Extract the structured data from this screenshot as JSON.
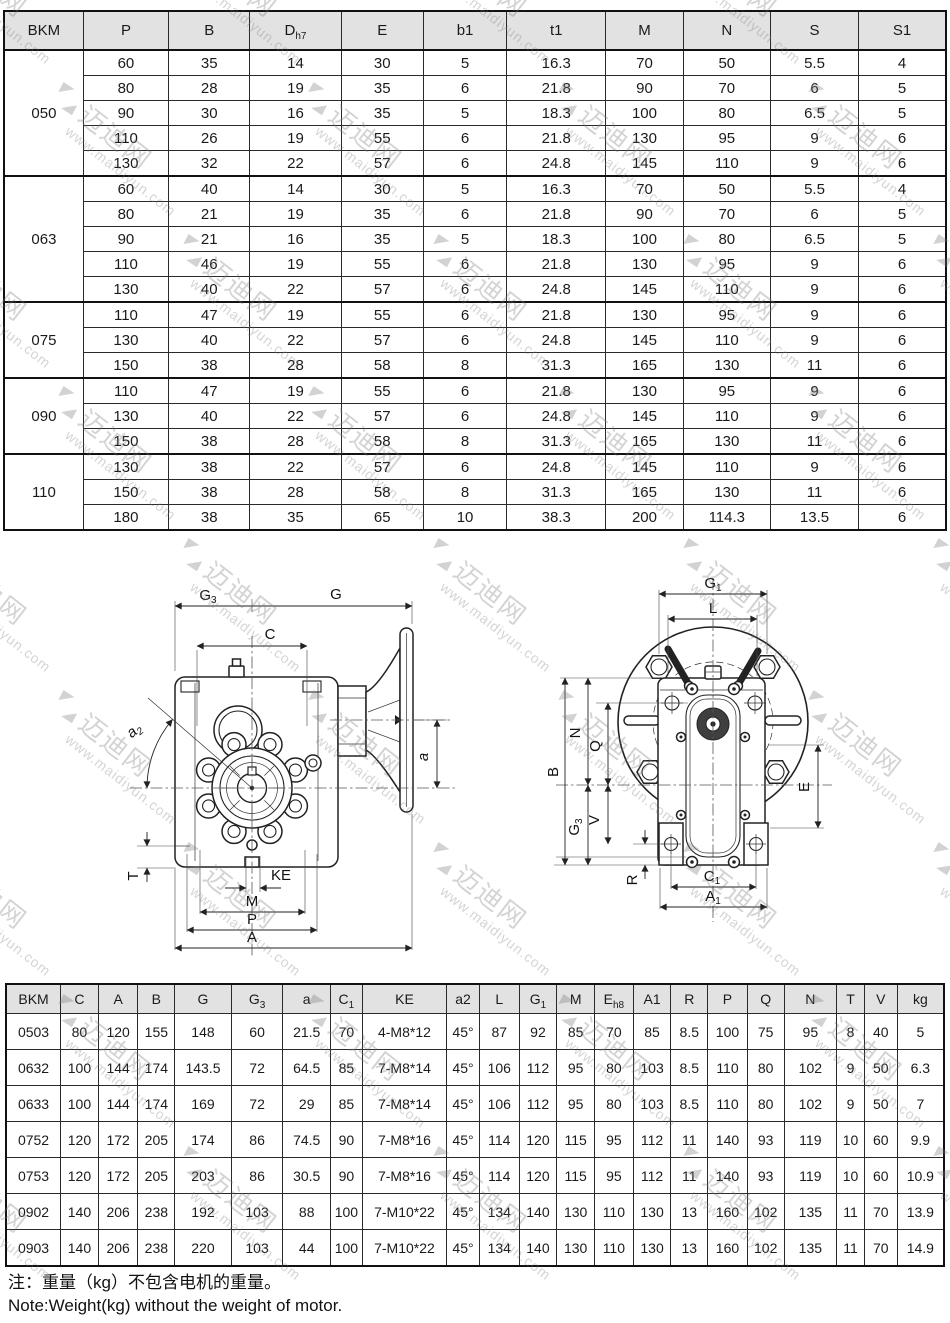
{
  "watermark": {
    "cn": "迈迪网",
    "url": "www.maidiyun.com"
  },
  "table1": {
    "headers": [
      {
        "t": "BKM",
        "s": ""
      },
      {
        "t": "P",
        "s": ""
      },
      {
        "t": "B",
        "s": ""
      },
      {
        "t": "D",
        "s": "h7"
      },
      {
        "t": "E",
        "s": ""
      },
      {
        "t": "b1",
        "s": ""
      },
      {
        "t": "t1",
        "s": ""
      },
      {
        "t": "M",
        "s": ""
      },
      {
        "t": "N",
        "s": ""
      },
      {
        "t": "S",
        "s": ""
      },
      {
        "t": "S1",
        "s": ""
      }
    ],
    "groups": [
      {
        "bkm": "050",
        "rows": [
          [
            60,
            35,
            14,
            30,
            5,
            16.3,
            70,
            50,
            5.5,
            4
          ],
          [
            80,
            28,
            19,
            35,
            6,
            21.8,
            90,
            70,
            6,
            5
          ],
          [
            90,
            30,
            16,
            35,
            5,
            18.3,
            100,
            80,
            6.5,
            5
          ],
          [
            110,
            26,
            19,
            55,
            6,
            21.8,
            130,
            95,
            9,
            6
          ],
          [
            130,
            32,
            22,
            57,
            6,
            24.8,
            145,
            110,
            9,
            6
          ]
        ]
      },
      {
        "bkm": "063",
        "rows": [
          [
            60,
            40,
            14,
            30,
            5,
            16.3,
            70,
            50,
            5.5,
            4
          ],
          [
            80,
            21,
            19,
            35,
            6,
            21.8,
            90,
            70,
            6,
            5
          ],
          [
            90,
            21,
            16,
            35,
            5,
            18.3,
            100,
            80,
            6.5,
            5
          ],
          [
            110,
            46,
            19,
            55,
            6,
            21.8,
            130,
            95,
            9,
            6
          ],
          [
            130,
            40,
            22,
            57,
            6,
            24.8,
            145,
            110,
            9,
            6
          ]
        ]
      },
      {
        "bkm": "075",
        "rows": [
          [
            110,
            47,
            19,
            55,
            6,
            21.8,
            130,
            95,
            9,
            6
          ],
          [
            130,
            40,
            22,
            57,
            6,
            24.8,
            145,
            110,
            9,
            6
          ],
          [
            150,
            38,
            28,
            58,
            8,
            31.3,
            165,
            130,
            11,
            6
          ]
        ]
      },
      {
        "bkm": "090",
        "rows": [
          [
            110,
            47,
            19,
            55,
            6,
            21.8,
            130,
            95,
            9,
            6
          ],
          [
            130,
            40,
            22,
            57,
            6,
            24.8,
            145,
            110,
            9,
            6
          ],
          [
            150,
            38,
            28,
            58,
            8,
            31.3,
            165,
            130,
            11,
            6
          ]
        ]
      },
      {
        "bkm": "110",
        "rows": [
          [
            130,
            38,
            22,
            57,
            6,
            24.8,
            145,
            110,
            9,
            6
          ],
          [
            150,
            38,
            28,
            58,
            8,
            31.3,
            165,
            130,
            11,
            6
          ],
          [
            180,
            38,
            35,
            65,
            10,
            38.3,
            200,
            114.3,
            13.5,
            6
          ]
        ]
      }
    ]
  },
  "table2": {
    "headers": [
      {
        "t": "BKM",
        "s": ""
      },
      {
        "t": "C",
        "s": ""
      },
      {
        "t": "A",
        "s": ""
      },
      {
        "t": "B",
        "s": ""
      },
      {
        "t": "G",
        "s": ""
      },
      {
        "t": "G",
        "s": "3"
      },
      {
        "t": "a",
        "s": ""
      },
      {
        "t": "C",
        "s": "1"
      },
      {
        "t": "KE",
        "s": ""
      },
      {
        "t": "a2",
        "s": ""
      },
      {
        "t": "L",
        "s": ""
      },
      {
        "t": "G",
        "s": "1"
      },
      {
        "t": "M",
        "s": ""
      },
      {
        "t": "E",
        "s": "h8"
      },
      {
        "t": "A1",
        "s": ""
      },
      {
        "t": "R",
        "s": ""
      },
      {
        "t": "P",
        "s": ""
      },
      {
        "t": "Q",
        "s": ""
      },
      {
        "t": "N",
        "s": ""
      },
      {
        "t": "T",
        "s": ""
      },
      {
        "t": "V",
        "s": ""
      },
      {
        "t": "kg",
        "s": ""
      }
    ],
    "rows": [
      [
        "0503",
        80,
        120,
        155,
        148,
        60,
        21.5,
        70,
        "4-M8*12",
        "45°",
        87,
        92,
        85,
        70,
        85,
        8.5,
        100,
        75,
        95,
        8,
        40,
        5
      ],
      [
        "0632",
        100,
        144,
        174,
        143.5,
        72,
        64.5,
        85,
        "7-M8*14",
        "45°",
        106,
        112,
        95,
        80,
        103,
        8.5,
        110,
        80,
        102,
        9,
        50,
        6.3
      ],
      [
        "0633",
        100,
        144,
        174,
        169,
        72,
        29,
        85,
        "7-M8*14",
        "45°",
        106,
        112,
        95,
        80,
        103,
        8.5,
        110,
        80,
        102,
        9,
        50,
        7
      ],
      [
        "0752",
        120,
        172,
        205,
        174,
        86,
        74.5,
        90,
        "7-M8*16",
        "45°",
        114,
        120,
        115,
        95,
        112,
        11,
        140,
        93,
        119,
        10,
        60,
        9.9
      ],
      [
        "0753",
        120,
        172,
        205,
        203,
        86,
        30.5,
        90,
        "7-M8*16",
        "45°",
        114,
        120,
        115,
        95,
        112,
        11,
        140,
        93,
        119,
        10,
        60,
        10.9
      ],
      [
        "0902",
        140,
        206,
        238,
        192,
        103,
        88,
        100,
        "7-M10*22",
        "45°",
        134,
        140,
        130,
        110,
        130,
        13,
        160,
        102,
        135,
        11,
        70,
        13.9
      ],
      [
        "0903",
        140,
        206,
        238,
        220,
        103,
        44,
        100,
        "7-M10*22",
        "45°",
        134,
        140,
        130,
        110,
        130,
        13,
        160,
        102,
        135,
        11,
        70,
        14.9
      ]
    ]
  },
  "notes": {
    "cn": "注：重量（kg）不包含电机的重量。",
    "en": "Note:Weight(kg) without the weight of motor."
  },
  "drawings": {
    "left": {
      "labels": {
        "g3": {
          "t": "G",
          "s": "3"
        },
        "g": {
          "t": "G",
          "s": ""
        },
        "c": {
          "t": "C",
          "s": ""
        },
        "a2": {
          "t": "a",
          "s": "2"
        },
        "a": {
          "t": "a",
          "s": ""
        },
        "t": {
          "t": "T",
          "s": ""
        },
        "ke": {
          "t": "KE",
          "s": ""
        },
        "m": {
          "t": "M",
          "s": ""
        },
        "p": {
          "t": "P",
          "s": ""
        },
        "a_all": {
          "t": "A",
          "s": ""
        }
      }
    },
    "right": {
      "labels": {
        "g1": {
          "t": "G",
          "s": "1"
        },
        "l": {
          "t": "L",
          "s": ""
        },
        "b": {
          "t": "B",
          "s": ""
        },
        "n": {
          "t": "N",
          "s": ""
        },
        "q": {
          "t": "Q",
          "s": ""
        },
        "g3": {
          "t": "G",
          "s": "3"
        },
        "v": {
          "t": "V",
          "s": ""
        },
        "r": {
          "t": "R",
          "s": ""
        },
        "e": {
          "t": "E",
          "s": ""
        },
        "c1": {
          "t": "C",
          "s": "1"
        },
        "a1": {
          "t": "A",
          "s": "1"
        }
      }
    }
  }
}
